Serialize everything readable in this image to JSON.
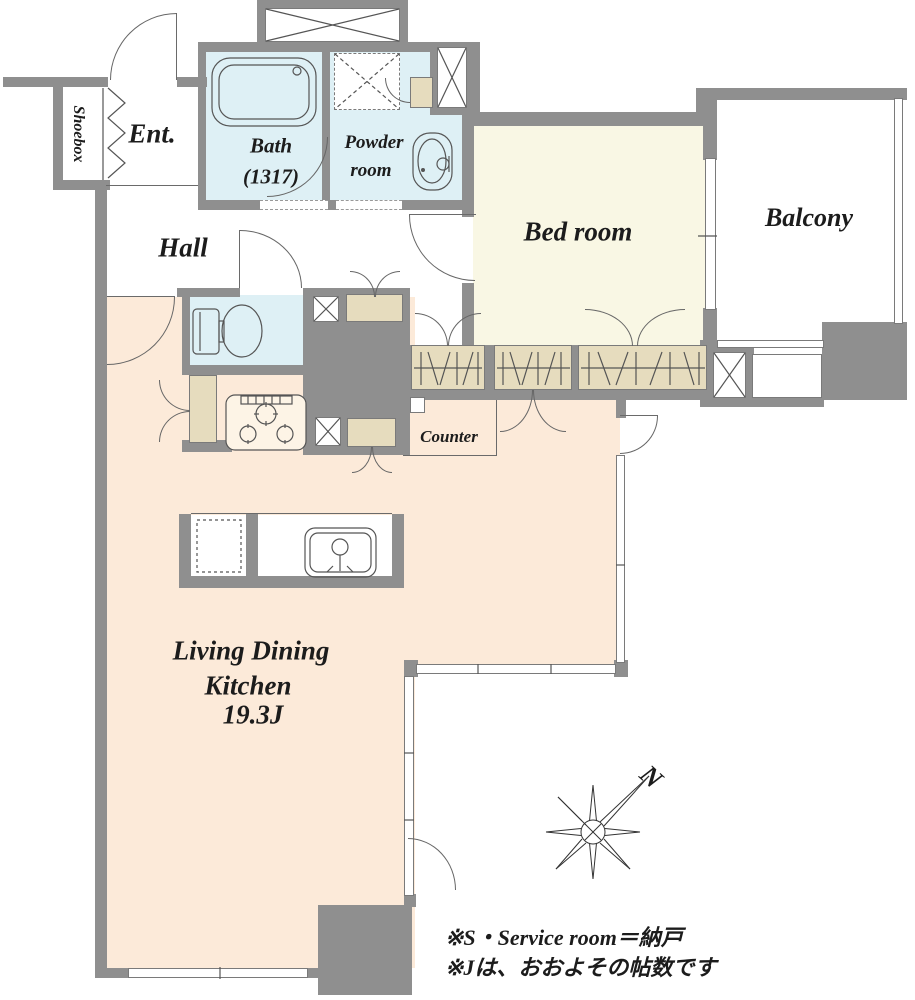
{
  "floorplan": {
    "rooms": {
      "shoebox": {
        "label": "Shoebox"
      },
      "entrance": {
        "label": "Ent."
      },
      "bath": {
        "label": "Bath",
        "size": "(1317)"
      },
      "powder": {
        "line1": "Powder",
        "line2": "room"
      },
      "hall": {
        "label": "Hall"
      },
      "bedroom": {
        "label": "Bed room"
      },
      "balcony": {
        "label": "Balcony"
      },
      "counter": {
        "label": "Counter"
      },
      "ldk": {
        "line1": "Living Dining",
        "line2": "Kitchen",
        "line3": "19.3J"
      }
    },
    "compass": {
      "north_label": "N"
    },
    "notes": {
      "line1": "※S・Service room＝納戸",
      "line2": "※Jは、おおよその帖数です"
    },
    "icons": {
      "compass": "compass-rose-icon",
      "shaft": "pipe-space-x-icon",
      "washer": "washing-machine-pan-icon",
      "tub": "bathtub-icon",
      "toilet": "toilet-icon",
      "stove": "gas-stove-icon",
      "sink": "kitchen-sink-icon",
      "basin": "wash-basin-icon"
    },
    "colors": {
      "wall": "#8f8f8f",
      "ldk_floor": "#fcead9",
      "bedroom_floor": "#f9f7e4",
      "wet_area_floor": "#def0f5",
      "cabinet": "#e6dcbe",
      "line": "#555555"
    }
  }
}
